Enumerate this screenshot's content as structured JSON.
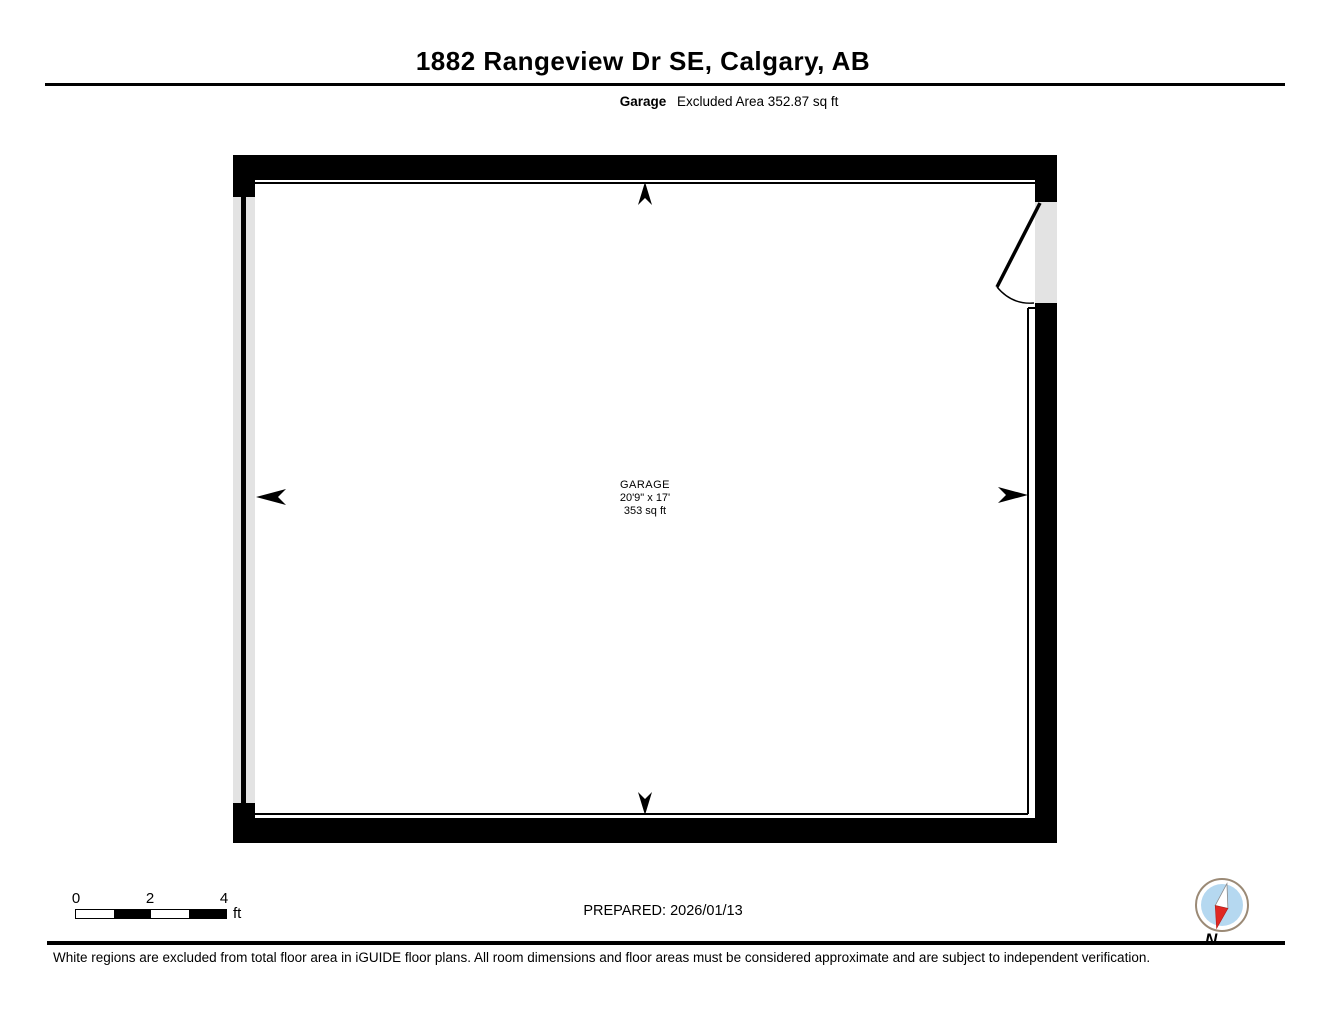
{
  "header": {
    "title": "1882 Rangeview Dr SE, Calgary, AB",
    "floor_label": "Garage",
    "excluded_area": "Excluded Area 352.87 sq ft"
  },
  "floorplan": {
    "room": {
      "name": "GARAGE",
      "dimensions": "20'9\" x 17'",
      "area": "353 sq ft"
    },
    "features": [
      "garage-door-left-wall",
      "swing-door-right-wall",
      "dimension-arrows"
    ]
  },
  "scale_bar": {
    "tick_labels": [
      "0",
      "2",
      "4"
    ],
    "unit": "ft"
  },
  "footer": {
    "prepared": "PREPARED: 2026/01/13",
    "compass_label": "N",
    "disclaimer": "White regions are excluded from total floor area in iGUIDE floor plans. All room dimensions and floor areas must be considered approximate and are subject to independent verification."
  },
  "colors": {
    "wall": "#000000",
    "opening_fill": "#e3e3e3",
    "compass_blue": "#b5d8f0",
    "compass_red": "#e02823",
    "compass_ring": "#9b8a76"
  }
}
